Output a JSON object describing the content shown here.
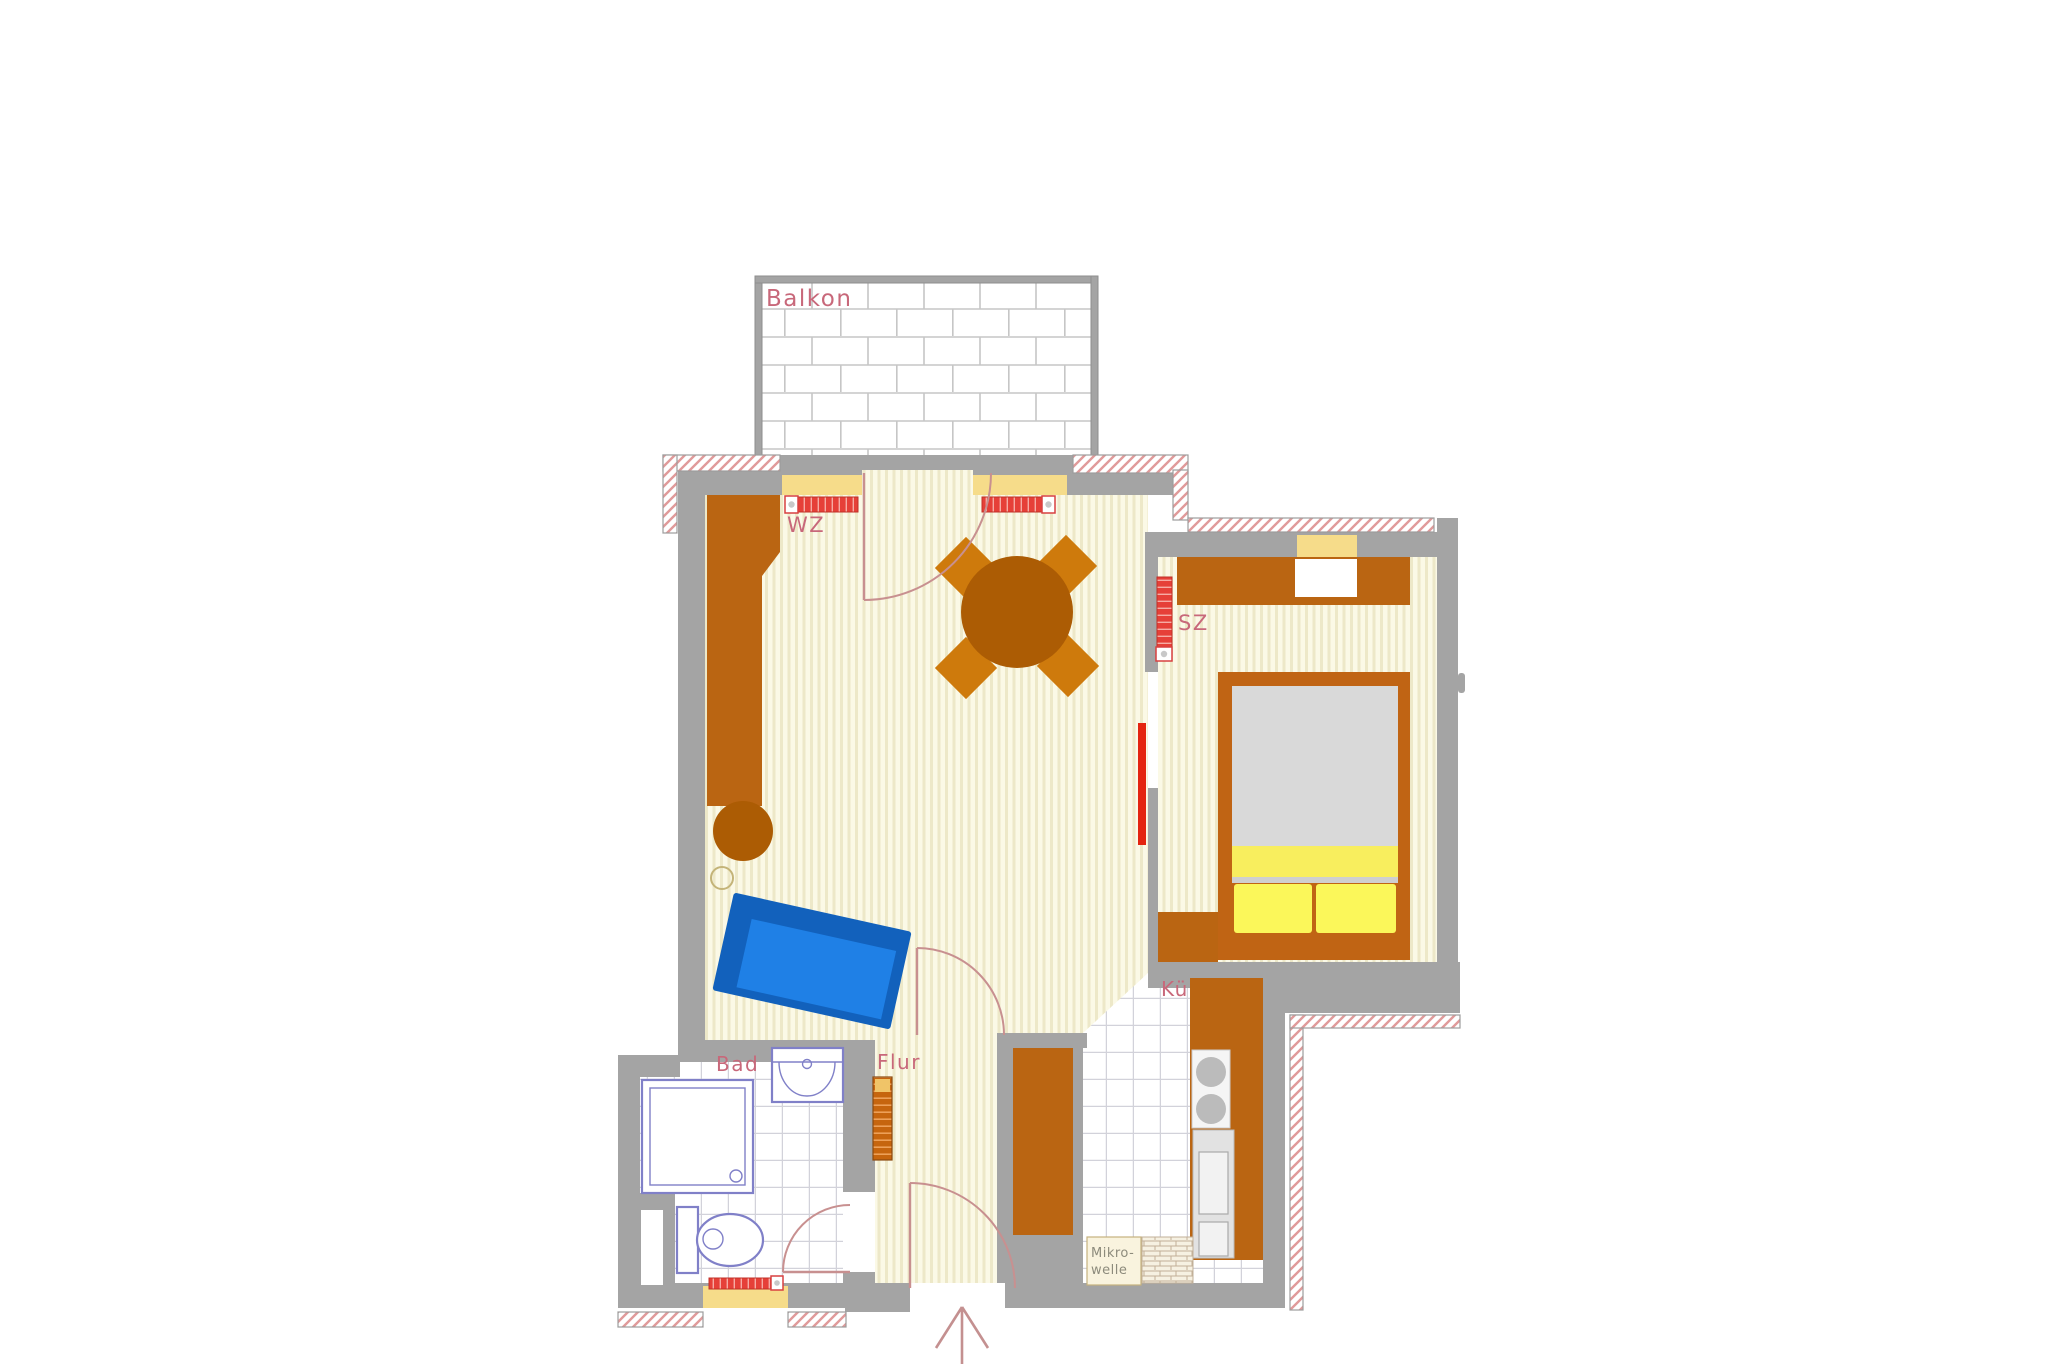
{
  "floorplan": {
    "rooms": [
      {
        "id": "balcony",
        "label": "Balkon"
      },
      {
        "id": "living-room",
        "label": "WZ"
      },
      {
        "id": "bedroom",
        "label": "SZ"
      },
      {
        "id": "bathroom",
        "label": "Bad"
      },
      {
        "id": "hallway",
        "label": "Flur"
      },
      {
        "id": "kitchen",
        "label": "Kü"
      }
    ],
    "annotations": {
      "microwave_line1": "Mikro-",
      "microwave_line2": "welle"
    },
    "colors": {
      "wall_gray": "#A4A4A4",
      "hatch_line": "#E09A9A",
      "floor_base": "#FBF9E6",
      "floor_stripe": "#EDE8C8",
      "tile_line": "#D2D2DA",
      "brick_line": "#C6C6C6",
      "window_sill": "#F6DC8A",
      "radiator_red": "#E64038",
      "furniture_brown": "#BA6512",
      "table_brown": "#AC5C04",
      "chair_orange": "#CE7A0C",
      "sofa_blue": "#1F80E6",
      "sofa_blue_dark": "#1261BC",
      "bed_frame": "#C06414",
      "bed_mattress": "#D9D9D9",
      "bed_yellow": "#F8EE5E",
      "bed_pillow": "#FBF75A",
      "fixture_outline": "#8080C8",
      "door_arc": "#C89090",
      "sliding_door_red": "#E42510",
      "label_pink": "#C8687A",
      "annotation_gray": "#8D8B7C"
    }
  }
}
